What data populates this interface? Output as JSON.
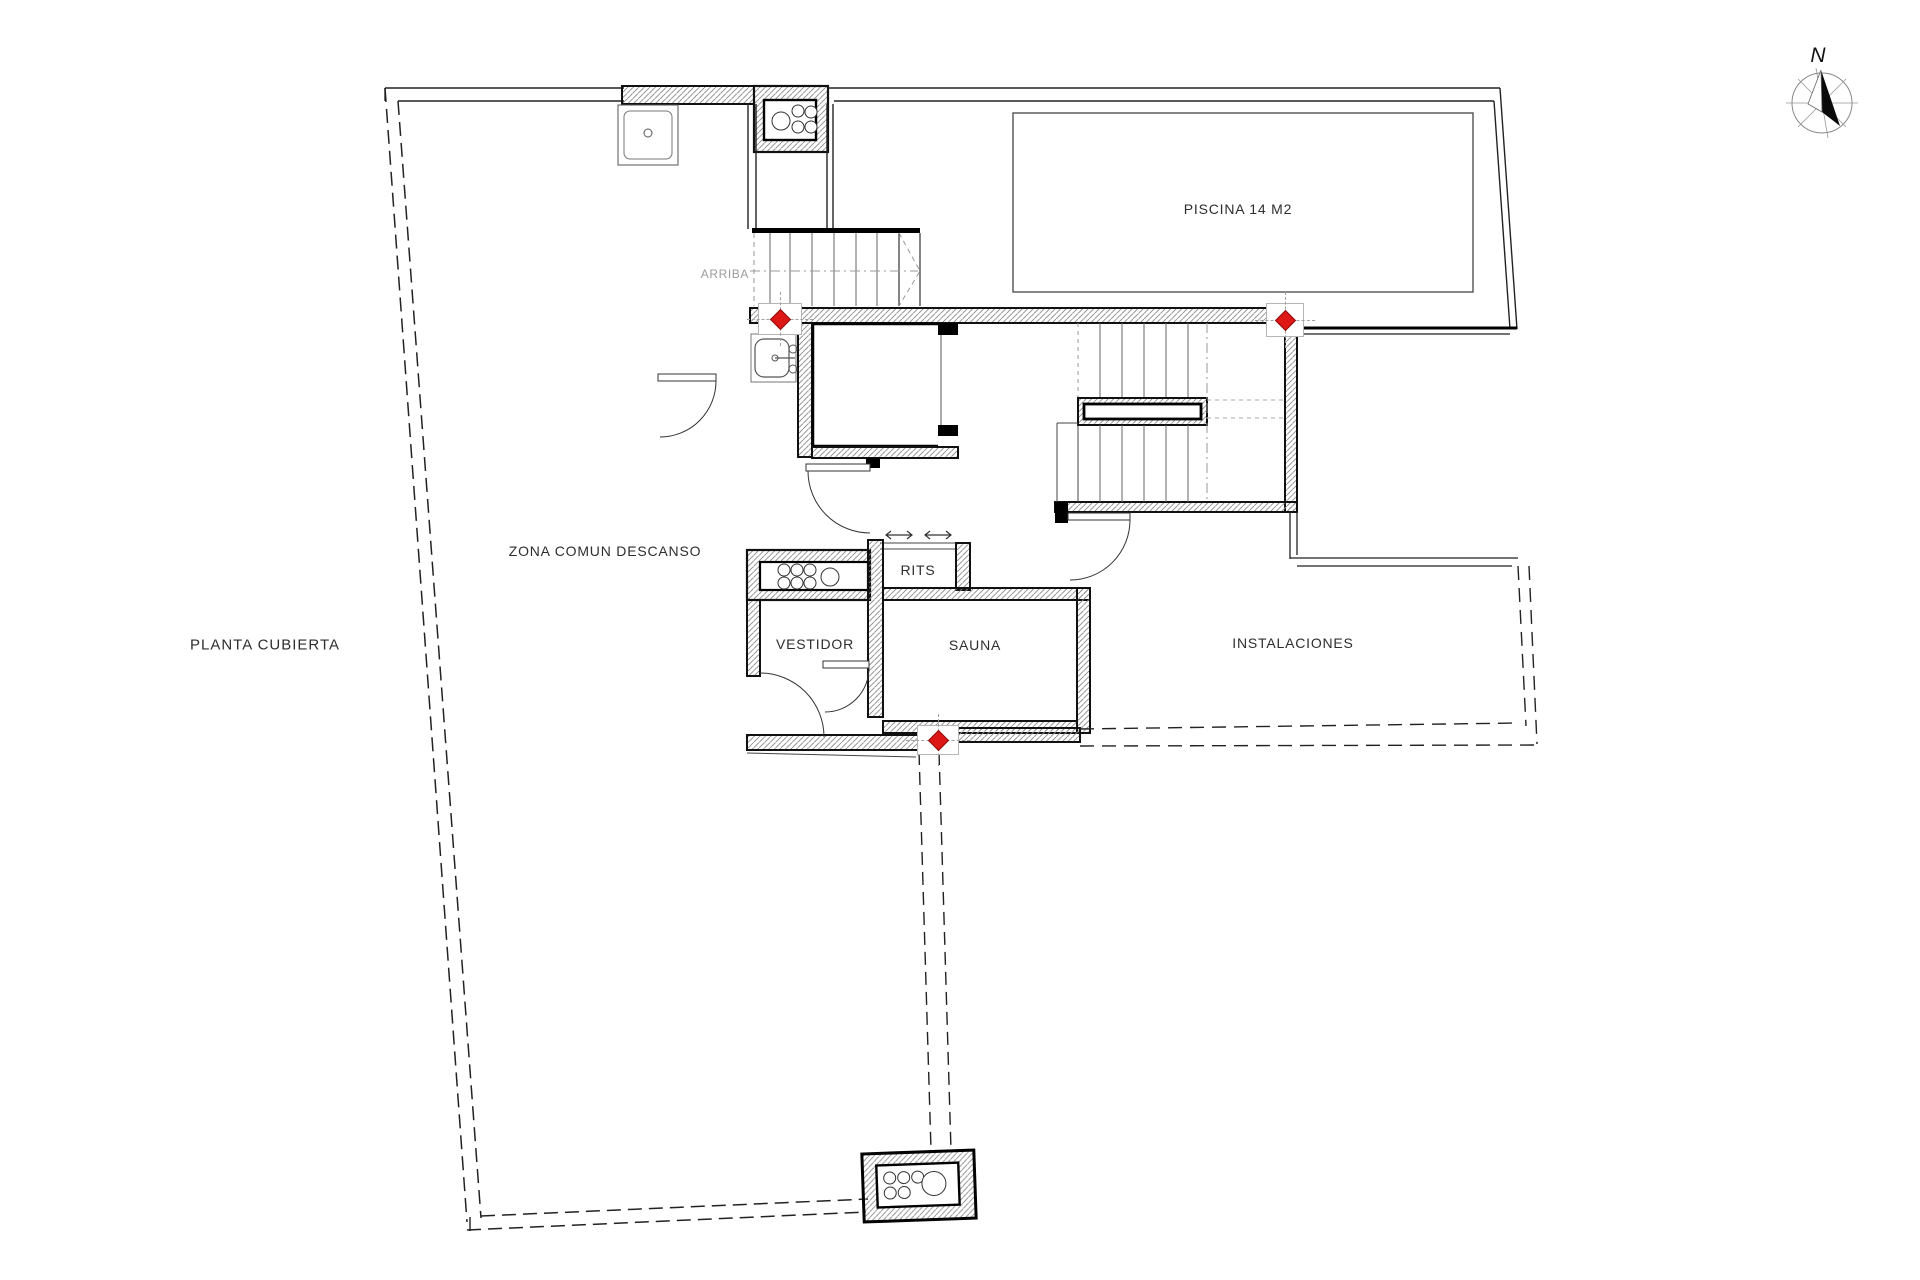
{
  "document": {
    "type": "architectural-floor-plan",
    "floor_label": "PLANTA CUBIERTA"
  },
  "compass": {
    "north_label": "N"
  },
  "stairs": {
    "direction_label": "ARRIBA"
  },
  "rooms": [
    {
      "id": "zona-comun-descanso",
      "label": "ZONA COMUN DESCANSO"
    },
    {
      "id": "piscina",
      "label": "PISCINA 14 M2"
    },
    {
      "id": "rits",
      "label": "RITS"
    },
    {
      "id": "vestidor",
      "label": "VESTIDOR"
    },
    {
      "id": "sauna",
      "label": "SAUNA"
    },
    {
      "id": "instalaciones",
      "label": "INSTALACIONES"
    }
  ],
  "markers": {
    "type": "level-marker",
    "count": 3,
    "color": "#dd1616"
  },
  "colors": {
    "background": "#ffffff",
    "wall_outline": "#111111",
    "wall_hatch": "#8a8a8a",
    "thin_line": "#2a2a2a",
    "tread_line": "#666666",
    "text": "#2e2e2e",
    "muted_text": "#9b9b9b",
    "marker_red": "#dd1616"
  }
}
